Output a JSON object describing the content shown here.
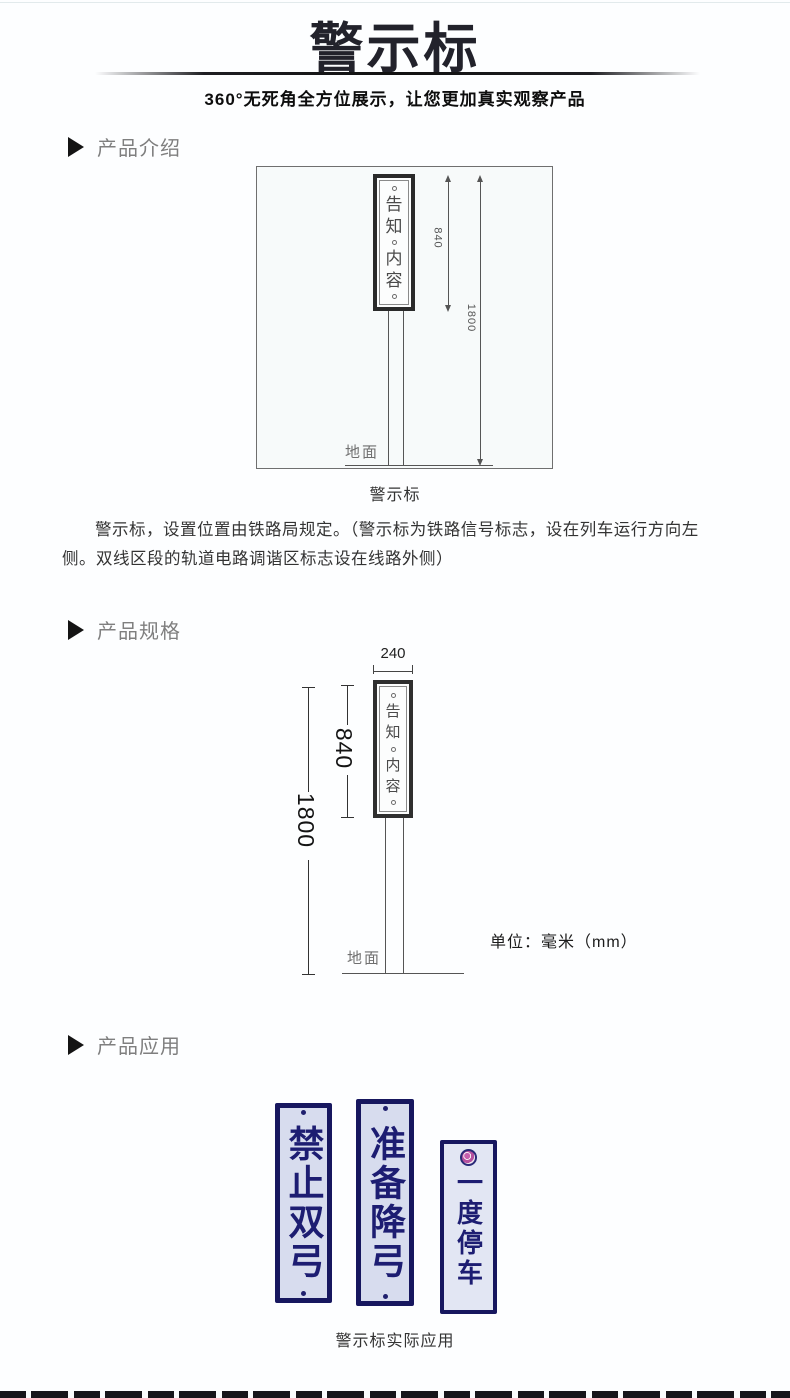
{
  "header": {
    "title": "警示标",
    "subtitle": "360°无死角全方位展示，让您更加真实观察产品"
  },
  "sections": {
    "intro_label": "产品介绍",
    "spec_label": "产品规格",
    "app_label": "产品应用"
  },
  "figure_intro": {
    "sign_chars": [
      "告",
      "知",
      "内",
      "容"
    ],
    "dim_sign_height": "840",
    "dim_total_height": "1800",
    "ground_label": "地面",
    "caption": "警示标"
  },
  "intro_paragraph": "警示标，设置位置由铁路局规定。（警示标为铁路信号标志，设在列车运行方向左侧。双线区段的轨道电路调谐区标志设在线路外侧）",
  "figure_spec": {
    "dim_width": "240",
    "dim_sign_height": "840",
    "dim_total_height": "1800",
    "sign_chars": [
      "告",
      "知",
      "内",
      "容"
    ],
    "ground_label": "地面",
    "unit_label": "单位：毫米（mm）"
  },
  "application": {
    "signs": [
      {
        "text": "禁止双弓"
      },
      {
        "text": "准备降弓"
      },
      {
        "text": "一度停车"
      }
    ],
    "caption": "警示标实际应用"
  },
  "colors": {
    "title_color": "#22222b",
    "section_label_color": "#7f7f7f",
    "diagram_line_color": "#555555",
    "app_sign_navy": "#1d1d72",
    "app_sign_background": "#d7dcee",
    "emblem_magenta": "#c75fae"
  }
}
